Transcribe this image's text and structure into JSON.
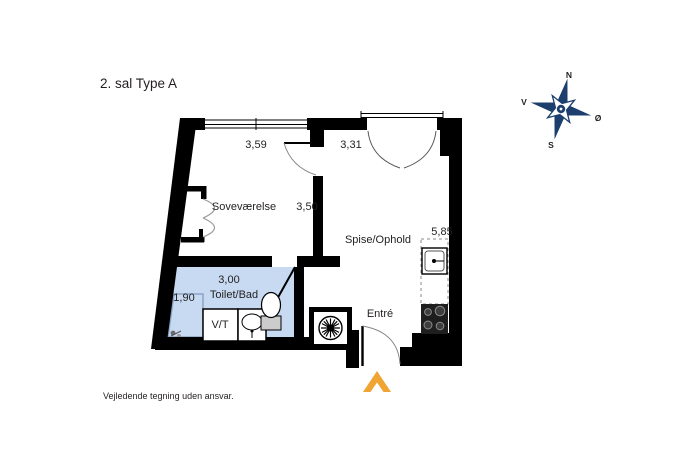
{
  "page": {
    "title": "2. sal Type A",
    "disclaimer": "Vejledende tegning uden ansvar."
  },
  "compass": {
    "n": "N",
    "s": "S",
    "v": "V",
    "o": "Ø"
  },
  "floorplan": {
    "rooms": [
      {
        "id": "sovevaerelse",
        "label": "Soveværelse"
      },
      {
        "id": "spise-ophold",
        "label": "Spise/Ophold"
      },
      {
        "id": "toilet-bad",
        "label": "Toilet/Bad"
      },
      {
        "id": "entre",
        "label": "Entré"
      },
      {
        "id": "vt",
        "label": "V/T"
      }
    ],
    "dimensions": [
      {
        "id": "window-width",
        "value": "3,59"
      },
      {
        "id": "balcony-door-width",
        "value": "3,31"
      },
      {
        "id": "bedroom-depth",
        "value": "3,50"
      },
      {
        "id": "living-depth",
        "value": "5,85"
      },
      {
        "id": "bath-width",
        "value": "3,00"
      },
      {
        "id": "bath-depth",
        "value": "1,90"
      }
    ],
    "colors": {
      "wall": "#000000",
      "bath_fill": "#c7daf2",
      "entry_arrow": "#f0a431",
      "compass": "#1c3f6e"
    }
  }
}
